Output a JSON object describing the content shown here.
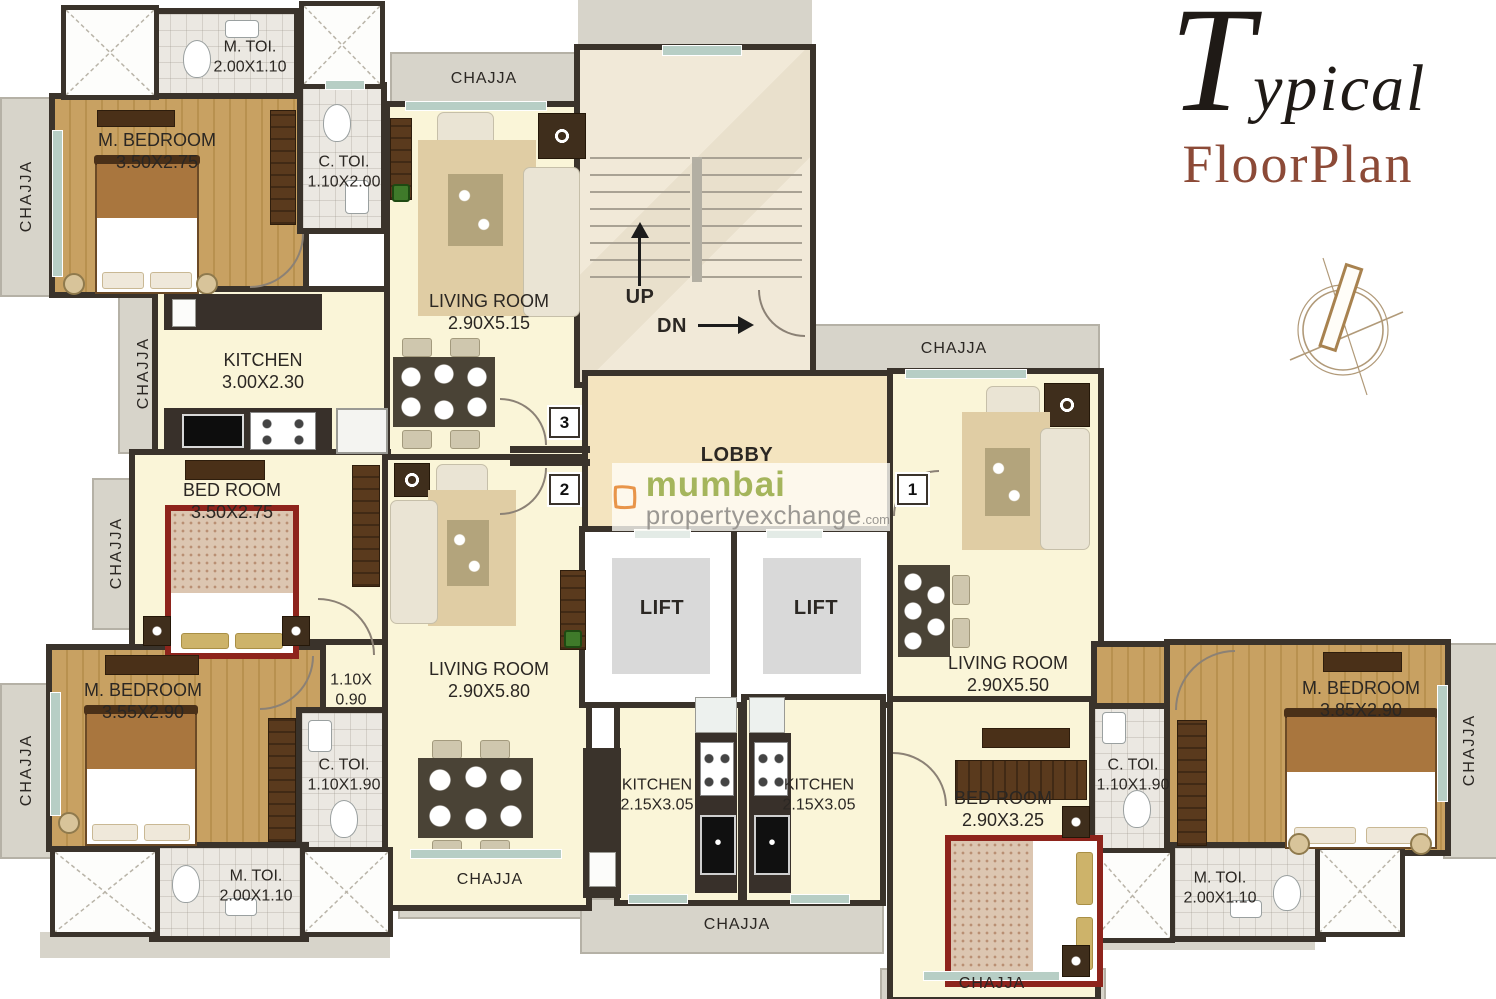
{
  "title": {
    "swash": "T",
    "rest": "ypical",
    "line2": "FloorPlan"
  },
  "watermark": {
    "brand": "mumbai",
    "domain": "propertyexchange",
    "tld": ".com"
  },
  "labels": {
    "chajja": "CHAJJA",
    "lobby": "LOBBY",
    "lift": "LIFT",
    "up": "UP",
    "dn": "DN",
    "units": [
      "3",
      "2",
      "1"
    ]
  },
  "rooms": [
    {
      "name": "M. TOI.",
      "dims": "2.00X1.10"
    },
    {
      "name": "M. BEDROOM",
      "dims": "3.50X2.75"
    },
    {
      "name": "C. TOI.",
      "dims": "1.10X2.00"
    },
    {
      "name": "LIVING ROOM",
      "dims": "2.90X5.15"
    },
    {
      "name": "KITCHEN",
      "dims": "3.00X2.30"
    },
    {
      "name": "BED ROOM",
      "dims": "3.50X2.75"
    },
    {
      "name": "1.10X",
      "dims": "0.90"
    },
    {
      "name": "M. BEDROOM",
      "dims": "3.55X2.90"
    },
    {
      "name": "C. TOI.",
      "dims": "1.10X1.90"
    },
    {
      "name": "M. TOI.",
      "dims": "2.00X1.10"
    },
    {
      "name": "LIVING ROOM",
      "dims": "2.90X5.80"
    },
    {
      "name": "KITCHEN",
      "dims": "2.15X3.05"
    },
    {
      "name": "KITCHEN",
      "dims": "2.15X3.05"
    },
    {
      "name": "LIVING ROOM",
      "dims": "2.90X5.50"
    },
    {
      "name": "BED ROOM",
      "dims": "2.90X3.25"
    },
    {
      "name": "C. TOI.",
      "dims": "1.10X1.90"
    },
    {
      "name": "M. BEDROOM",
      "dims": "3.85X2.90"
    },
    {
      "name": "M. TOI.",
      "dims": "2.00X1.10"
    }
  ],
  "colors": {
    "wall": "#3a332b",
    "floor_cream": "#faf5d8",
    "wood": "#c49a5e",
    "chajja_gray": "#d7d4ca",
    "title_accent": "#8c4a37",
    "brand_green": "#a5b55c",
    "brand_orange": "#e8954a"
  }
}
